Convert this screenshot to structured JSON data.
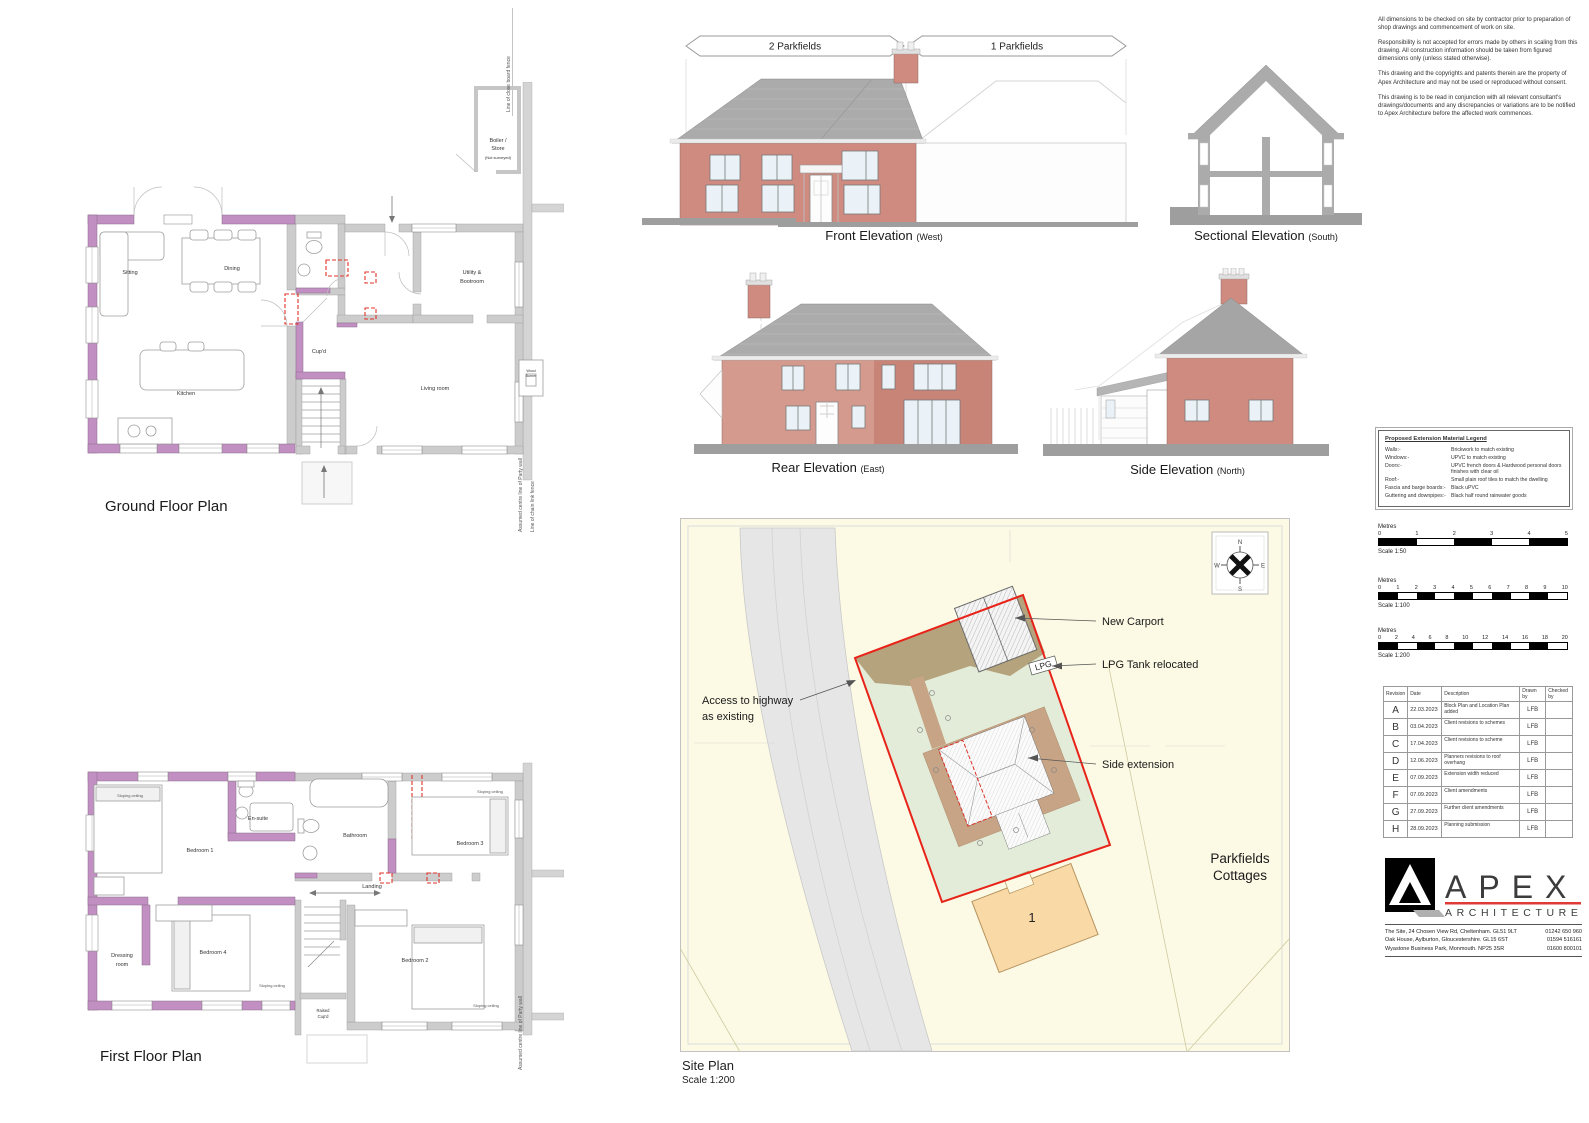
{
  "ground_floor": {
    "title": "Ground Floor Plan",
    "labels": {
      "sitting": "Sitting",
      "dining": "Dining",
      "kitchen": "Kitchen",
      "cupd": "Cup'd",
      "utility1": "Utility &",
      "utility2": "Bootroom",
      "living": "Living room",
      "boiler1": "Boiler /",
      "boiler2": "Store",
      "boiler3": "(Not surveyed)",
      "wood1": "Wood",
      "wood2": "Burner",
      "fence_top": "Line of close board fence",
      "party": "Assumed centre line of Party wall",
      "chain": "Line of chain link fence"
    }
  },
  "first_floor": {
    "title": "First Floor Plan",
    "labels": {
      "bed1": "Bedroom 1",
      "ensuite": "En-suite",
      "bathroom": "Bathroom",
      "bed3": "Bedroom 3",
      "landing": "Landing",
      "dressing1": "Dressing",
      "dressing2": "room",
      "bed4": "Bedroom 4",
      "bed2": "Bedroom 2",
      "raised1": "Raised",
      "raised2": "Cup'd",
      "sloping": "Sloping ceiling",
      "party": "Assumed centre line of Party wall"
    }
  },
  "elevations": {
    "front": {
      "title": "Front Elevation",
      "subtitle": "(West)",
      "dim_left": "2 Parkfields",
      "dim_right": "1 Parkfields"
    },
    "sectional": {
      "title": "Sectional Elevation",
      "subtitle": "(South)"
    },
    "rear": {
      "title": "Rear Elevation",
      "subtitle": "(East)"
    },
    "side": {
      "title": "Side Elevation",
      "subtitle": "(North)"
    }
  },
  "site": {
    "title": "Site Plan",
    "scale": "Scale 1:200",
    "access1": "Access to highway",
    "access2": "as existing",
    "carport": "New Carport",
    "lpg_relocated": "LPG Tank relocated",
    "extension": "Side extension",
    "cottages1": "Parkfields",
    "cottages2": "Cottages",
    "plot": "1",
    "lpg": "LPG",
    "compass": {
      "n": "N",
      "e": "E",
      "s": "S",
      "w": "W"
    }
  },
  "notes": {
    "p1": "All dimensions to be checked on site by contractor prior to preparation of shop drawings and commencement of work on site.",
    "p2": "Responsibility is not accepted for errors made by others in scaling from this drawing. All construction information should be taken from figured dimensions only (unless stated otherwise).",
    "p3": "This drawing and the copyrights and patents therein are the property of Apex Architecture and may not be used or reproduced without consent.",
    "p4": "This drawing is to be read in conjunction with all relevant consultant's drawings/documents and any discrepancies or variations are to be notified to Apex Architecture before the affected work commences."
  },
  "legend": {
    "title": "Proposed Extension Material Legend",
    "rows": [
      {
        "k": "Walls:-",
        "v": "Brickwork to match existing"
      },
      {
        "k": "Windows:-",
        "v": "UPVC to match existing"
      },
      {
        "k": "Doors:-",
        "v": "UPVC french doors & Hardwood personal doors finishes with clear oil"
      },
      {
        "k": "Roof:-",
        "v": "Small plain roof tiles to match the dwelling"
      },
      {
        "k": "Fascia and barge boards:-",
        "v": "Black uPVC"
      },
      {
        "k": "Guttering and downpipes:-",
        "v": "Black half round rainwater goods"
      }
    ]
  },
  "scalebars": [
    {
      "unit": "Metres",
      "label": "Scale 1:50",
      "ticks": [
        "0",
        "1",
        "2",
        "3",
        "4",
        "5"
      ]
    },
    {
      "unit": "Metres",
      "label": "Scale 1:100",
      "ticks": [
        "0",
        "1",
        "2",
        "3",
        "4",
        "5",
        "6",
        "7",
        "8",
        "9",
        "10"
      ]
    },
    {
      "unit": "Metres",
      "label": "Scale 1:200",
      "ticks": [
        "0",
        "2",
        "4",
        "6",
        "8",
        "10",
        "12",
        "14",
        "16",
        "18",
        "20"
      ]
    }
  ],
  "revisions": {
    "headers": [
      "Revision",
      "Date",
      "Description",
      "Drawn by",
      "Checked by"
    ],
    "rows": [
      {
        "rev": "A",
        "date": "22.03.2023",
        "desc": "Block Plan and Location Plan added",
        "by": "LFB"
      },
      {
        "rev": "B",
        "date": "03.04.2023",
        "desc": "Client revisions to schemes",
        "by": "LFB"
      },
      {
        "rev": "C",
        "date": "17.04.2023",
        "desc": "Client revisions to scheme",
        "by": "LFB"
      },
      {
        "rev": "D",
        "date": "12.06.2023",
        "desc": "Planners revisions to roof overhang",
        "by": "LFB"
      },
      {
        "rev": "E",
        "date": "07.09.2023",
        "desc": "Extension width reduced",
        "by": "LFB"
      },
      {
        "rev": "F",
        "date": "07.09.2023",
        "desc": "Client amendments",
        "by": "LFB"
      },
      {
        "rev": "G",
        "date": "27.09.2023",
        "desc": "Further client amendments",
        "by": "LFB"
      },
      {
        "rev": "H",
        "date": "28.09.2023",
        "desc": "Planning submission",
        "by": "LFB"
      }
    ]
  },
  "brand": {
    "name": "APEX",
    "tagline": "ARCHITECTURE",
    "addresses": [
      {
        "a": "The Site, 24 Chosen View Rd, Cheltenham. GL51 9LT",
        "p": "01242 650 960"
      },
      {
        "a": "Oak House, Aylburton, Gloucestershire. GL15 6ST",
        "p": "01594 516161"
      },
      {
        "a": "Wyastone Business Park, Monmouth. NP25 3SR",
        "p": "01600 800101"
      }
    ]
  }
}
